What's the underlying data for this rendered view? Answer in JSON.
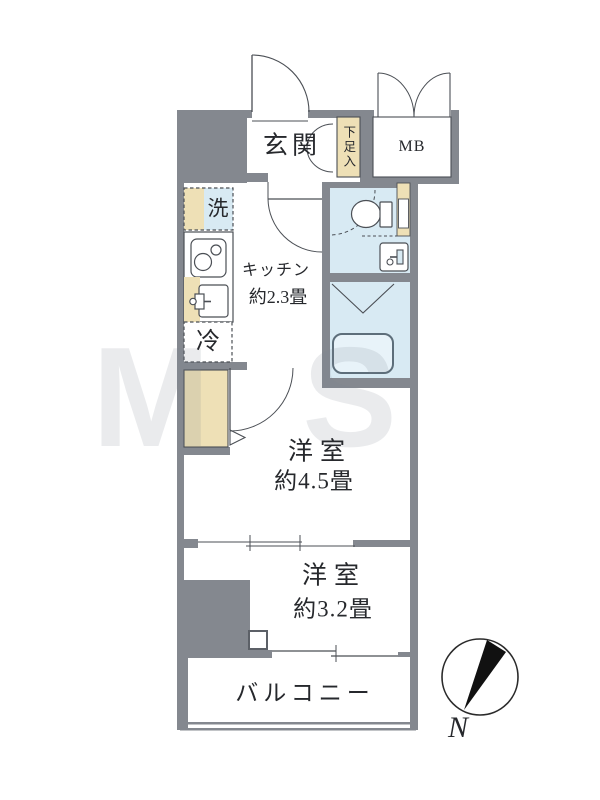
{
  "colors": {
    "wall_gray": "#84888f",
    "water_blue": "#d8eaf3",
    "bathtub_fill": "#e8f3f9",
    "bathtub_stroke": "#5d6e7a",
    "wood_beige": "#eee0b6",
    "outline": "#4b4f55",
    "text": "#26282c"
  },
  "plan": {
    "entrance": {
      "label": "玄関"
    },
    "shoe_cabinet": {
      "label": "下足入"
    },
    "meter_box": {
      "label": "MB"
    },
    "washing_machine": {
      "label": "洗"
    },
    "refrigerator": {
      "label": "冷"
    },
    "kitchen": {
      "label": "キッチン",
      "area": "約2.3畳"
    },
    "western_room_main": {
      "label": "洋室",
      "area": "約4.5畳"
    },
    "western_room_second": {
      "label": "洋室",
      "area": "約3.2畳"
    },
    "balcony": {
      "label": "バルコニー"
    }
  },
  "compass": {
    "north_label": "N"
  },
  "watermark": {
    "text": "MS"
  }
}
